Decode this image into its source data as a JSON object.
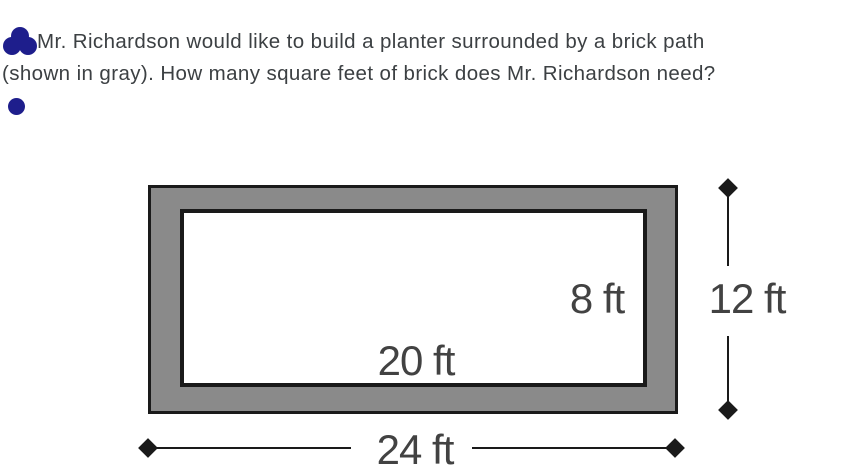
{
  "problem": {
    "line1": "Mr. Richardson would like to build a planter surrounded by a brick path",
    "line2": "(shown in gray). How many square feet of brick does Mr. Richardson need?"
  },
  "diagram": {
    "type": "nested-rectangles",
    "inner_height_label": "8 ft",
    "inner_width_label": "20 ft",
    "outer_height_label": "12 ft",
    "outer_width_label": "24 ft",
    "inner_width_ft": 20,
    "inner_height_ft": 8,
    "outer_width_ft": 24,
    "outer_height_ft": 12
  },
  "colors": {
    "path_gray": "#8a8a8a",
    "outline_black": "#1a1a1a",
    "dimension_text": "#424242",
    "body_text": "#3c4043",
    "icon_navy": "#1e1e8c"
  }
}
